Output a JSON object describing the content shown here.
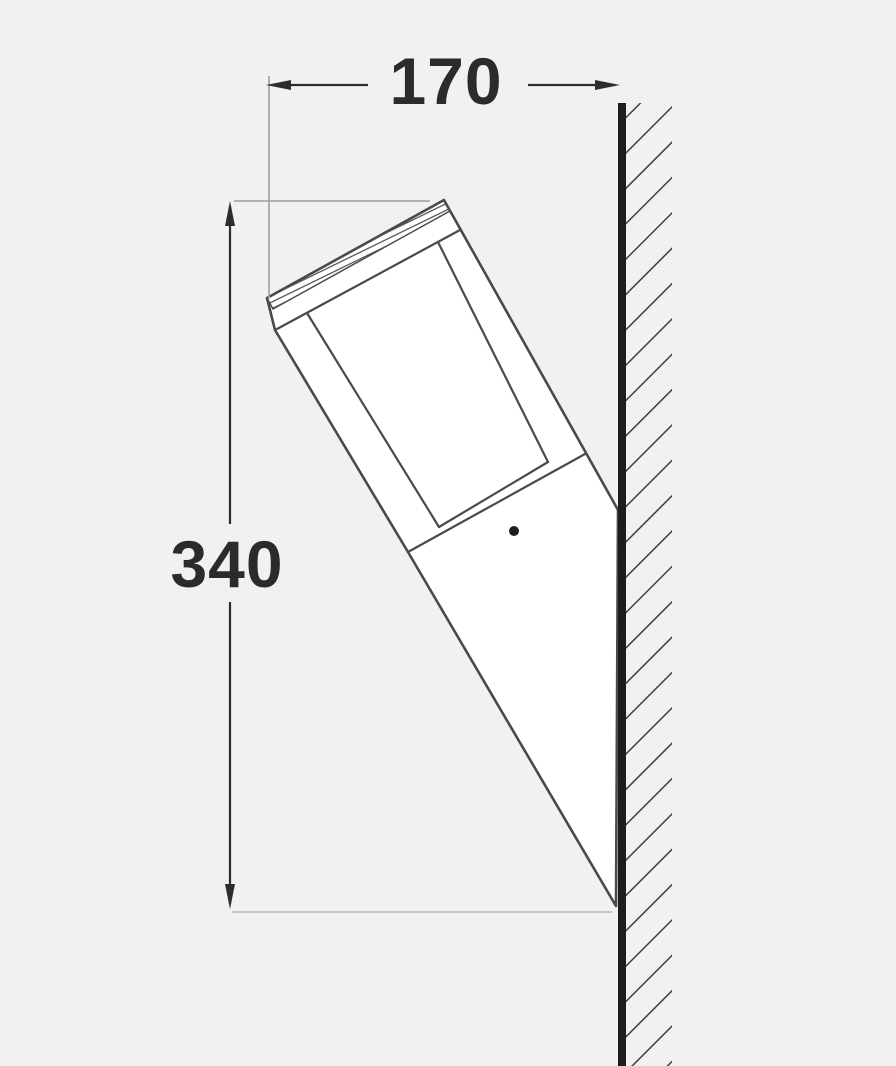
{
  "page": {
    "title": "Wall-mounted outdoor light fixture — side dimension drawing"
  },
  "dimensions": {
    "width": {
      "label": "170"
    },
    "height": {
      "label": "340"
    }
  },
  "drawing": {
    "parts": [
      "wall-section-with-hatching",
      "lamp-cap-with-shaded-top",
      "lamp-diffuser-tube",
      "lamp-tapered-body",
      "mounting-screw-dot"
    ],
    "colors": {
      "background": "#f1f1ef",
      "fixture_fill": "#ffffff",
      "line": "#4a4a4a",
      "wall": "#1d1d1b",
      "hatch": "#3f3f3f",
      "dimension": "#2d2d2d",
      "text": "#2b2b2b",
      "extension": "#a8a8a8",
      "extension_light": "#c6c6c6",
      "dot": "#1d1d1b"
    }
  }
}
